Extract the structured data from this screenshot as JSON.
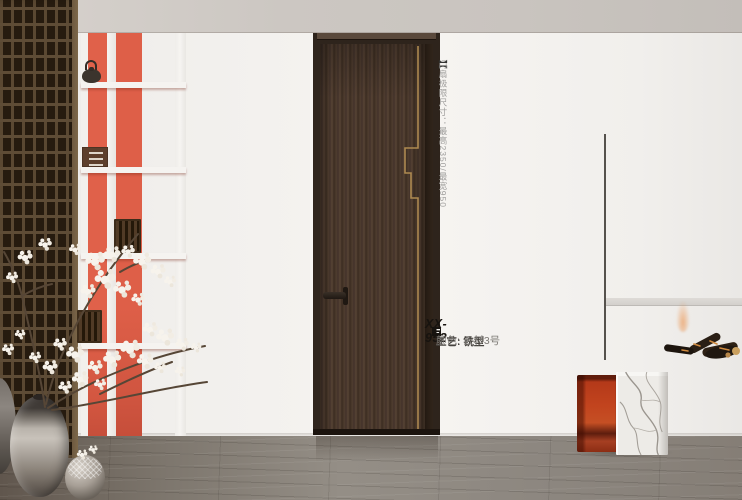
{
  "scene_title": "interior door product photo",
  "annotations": {
    "door_spec": {
      "bracket_open": "【",
      "text": "门扇极限尺寸：最高2350/最宽950",
      "bracket_close": "】"
    },
    "product": {
      "model": "XX-952",
      "craft_line": "工艺: 铣型",
      "color_line": "颜色: 云杉3号"
    }
  },
  "palette": {
    "accent_orange": "#E0614A",
    "accent_salmon": "#EA907A",
    "door_wood": "#4A382C",
    "gold_inlay": "#AD8950",
    "ceiling_gray": "#CCC7C2",
    "wall_white": "#F3F1EE",
    "floor_gray": "#8D8780",
    "stool_red": "#B83A1B",
    "marble_white": "#EDEBE7"
  }
}
